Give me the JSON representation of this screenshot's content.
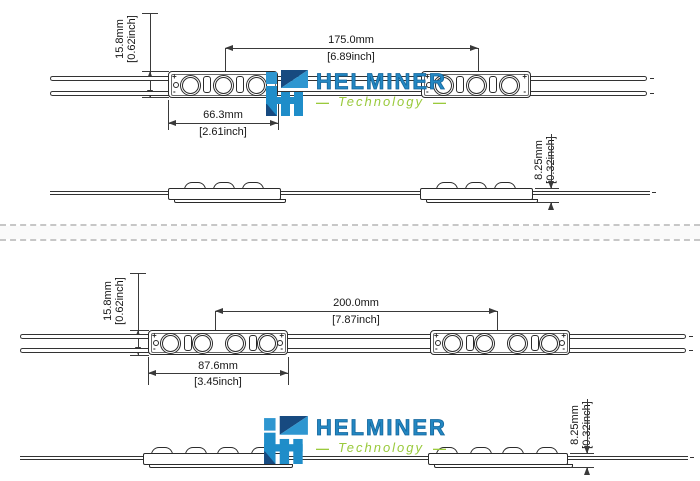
{
  "brand": {
    "name": "HELMINER",
    "tagline": "Technology",
    "dash": "—",
    "blue": "#2387c2",
    "green": "#9aca3c"
  },
  "polarity": {
    "plus": "+",
    "minus": "-"
  },
  "top_view": {
    "led_count": 3,
    "height_mm": "15.8mm",
    "height_inch": "[0.62inch]",
    "pitch_mm": "175.0mm",
    "pitch_inch": "[6.89inch]",
    "module_mm": "66.3mm",
    "module_inch": "[2.61inch]",
    "thickness_mm": "8.25mm",
    "thickness_inch": "[0.32inch]"
  },
  "bottom_view": {
    "led_count": 4,
    "height_mm": "15.8mm",
    "height_inch": "[0.62inch]",
    "pitch_mm": "200.0mm",
    "pitch_inch": "[7.87inch]",
    "module_mm": "87.6mm",
    "module_inch": "[3.45inch]",
    "thickness_mm": "8.25mm",
    "thickness_inch": "[0.32inch]"
  }
}
